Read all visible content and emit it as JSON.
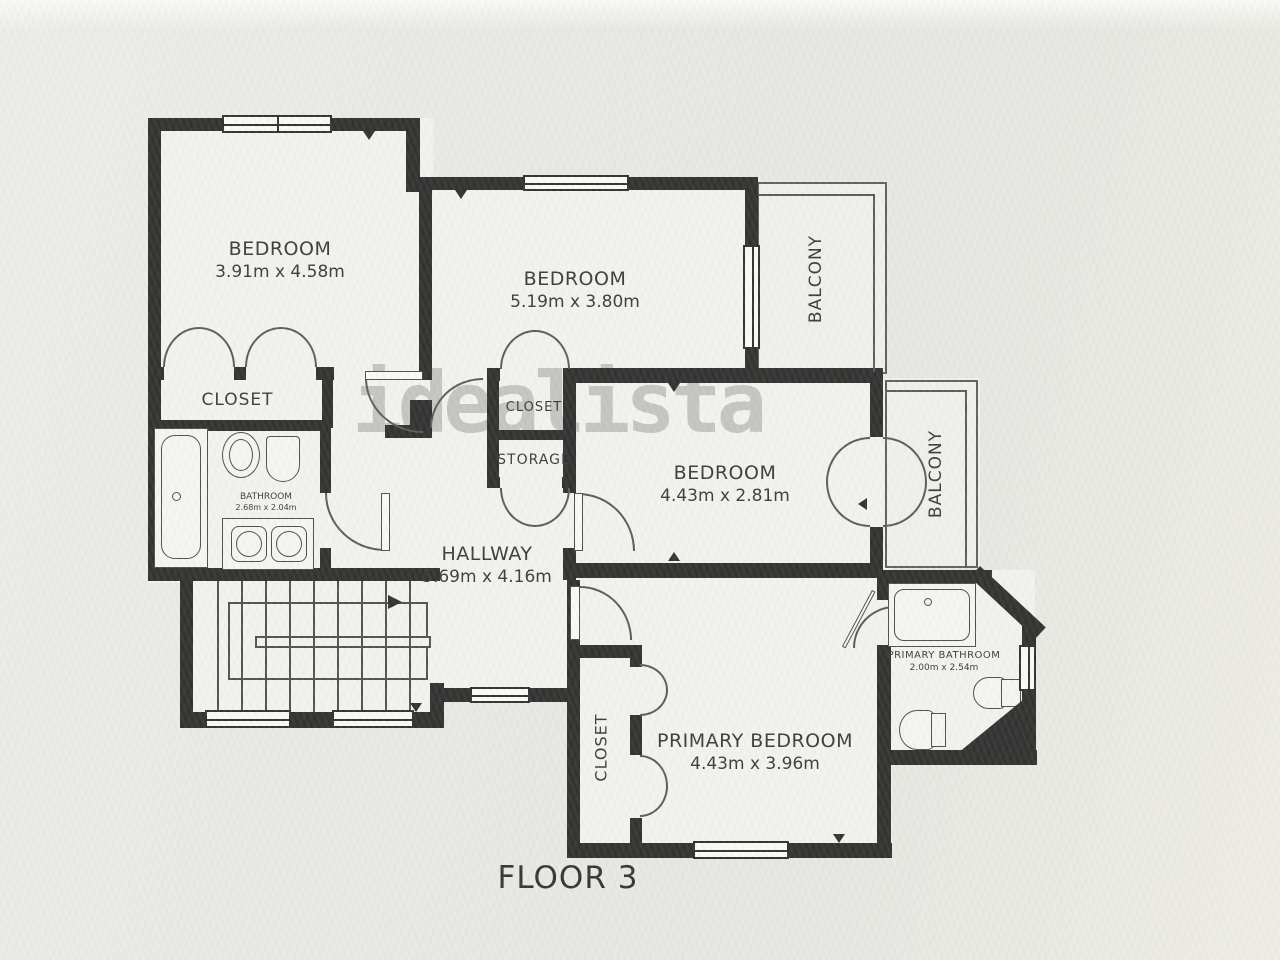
{
  "watermark": "idealista",
  "floor_label": "FLOOR 3",
  "rooms": {
    "bedroom1": {
      "name": "BEDROOM",
      "dims": "3.91m x 4.58m"
    },
    "bedroom2": {
      "name": "BEDROOM",
      "dims": "5.19m x 3.80m"
    },
    "bedroom3": {
      "name": "BEDROOM",
      "dims": "4.43m x 2.81m"
    },
    "primary_bedroom": {
      "name": "PRIMARY BEDROOM",
      "dims": "4.43m x 3.96m"
    },
    "hallway": {
      "name": "HALLWAY",
      "dims": "5.69m x 4.16m"
    },
    "bathroom": {
      "name": "BATHROOM",
      "dims": "2.68m x 2.04m"
    },
    "primary_bathroom": {
      "name": "PRIMARY BATHROOM",
      "dims": "2.00m x 2.54m"
    },
    "closet_bedroom1": {
      "name": "CLOSET"
    },
    "closet_middle": {
      "name": "CLOSET"
    },
    "storage": {
      "name": "STORAGE"
    },
    "closet_primary": {
      "name": "CLOSET"
    },
    "balcony_top": {
      "name": "BALCONY"
    },
    "balcony_middle": {
      "name": "BALCONY"
    }
  },
  "colors": {
    "wall": "#1b1b1b",
    "watermark_gray": "#7a7a7a",
    "paper": "#e9e8e4"
  }
}
